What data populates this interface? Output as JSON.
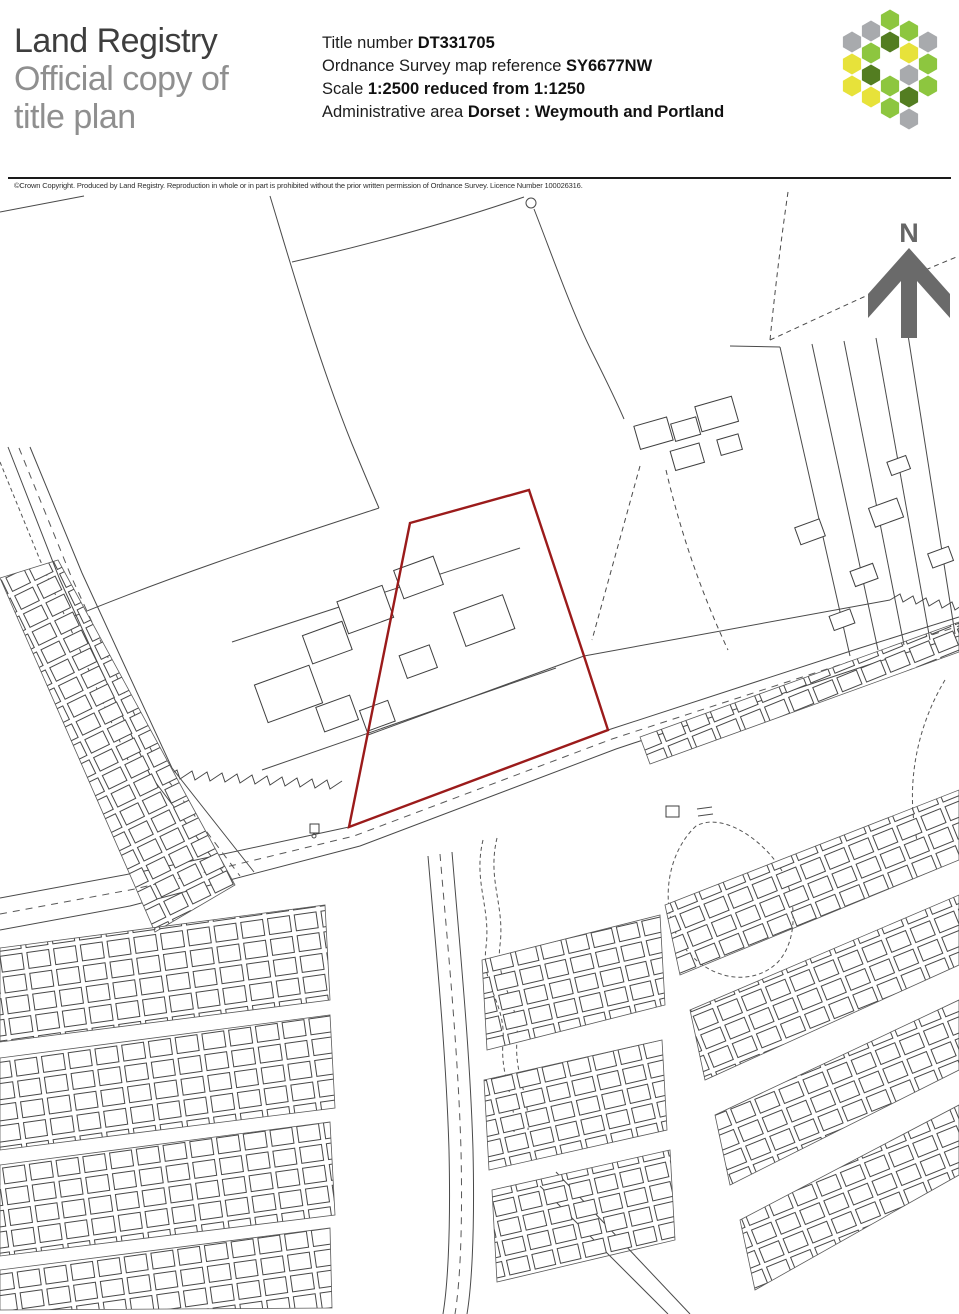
{
  "header": {
    "brand_line1": "Land Registry",
    "brand_line2": "Official copy of",
    "brand_line3": "title plan",
    "title_number_label": "Title number ",
    "title_number_value": "DT331705",
    "os_ref_label": "Ordnance Survey map reference ",
    "os_ref_value": "SY6677NW",
    "scale_label": "Scale ",
    "scale_value": "1:2500 reduced from 1:1250",
    "admin_area_label": "Administrative area ",
    "admin_area_value": "Dorset : Weymouth and Portland",
    "logo_colors": {
      "light_green": "#8dc63f",
      "dark_green": "#537d21",
      "yellow": "#e7e23a",
      "grey": "#a8aaad"
    }
  },
  "copyright_line": "©Crown Copyright.  Produced by Land Registry.  Reproduction in whole or in part is prohibited without the prior written permission of Ordnance Survey. Licence Number 100026316.",
  "map": {
    "north_label": "N",
    "boundary_color": "#9b1b1b",
    "title_boundary_points": "410,523 529,490 584,656 608,730 349,827",
    "interior_boundary_points": "368,735 584,656"
  }
}
